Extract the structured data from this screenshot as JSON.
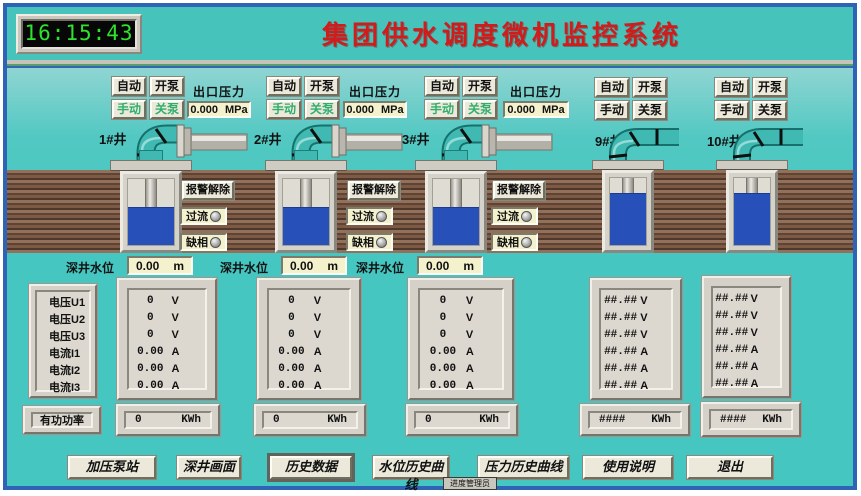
{
  "header": {
    "clock": "16:15:43",
    "title": "集团供水调度微机监控系统"
  },
  "controls": {
    "auto": "自动",
    "manual": "手动",
    "pump_on": "开泵",
    "pump_off": "关泵"
  },
  "stations": [
    {
      "name": "1#井",
      "pressure": {
        "label": "出口压力",
        "value": "0.000",
        "unit": "MPa"
      },
      "alarm": {
        "clear": "报警解除",
        "overcurrent": "过流",
        "phase_loss": "缺相"
      },
      "level": {
        "label": "深井水位",
        "value": "0.00",
        "unit": "m"
      },
      "meas": [
        {
          "v": "0",
          "u": "V"
        },
        {
          "v": "0",
          "u": "V"
        },
        {
          "v": "0",
          "u": "V"
        },
        {
          "v": "0.00",
          "u": "A"
        },
        {
          "v": "0.00",
          "u": "A"
        },
        {
          "v": "0.00",
          "u": "A"
        }
      ],
      "energy": {
        "v": "0",
        "u": "KWh"
      }
    },
    {
      "name": "2#井",
      "pressure": {
        "label": "出口压力",
        "value": "0.000",
        "unit": "MPa"
      },
      "alarm": {
        "clear": "报警解除",
        "overcurrent": "过流",
        "phase_loss": "缺相"
      },
      "level": {
        "label": "深井水位",
        "value": "0.00",
        "unit": "m"
      },
      "meas": [
        {
          "v": "0",
          "u": "V"
        },
        {
          "v": "0",
          "u": "V"
        },
        {
          "v": "0",
          "u": "V"
        },
        {
          "v": "0.00",
          "u": "A"
        },
        {
          "v": "0.00",
          "u": "A"
        },
        {
          "v": "0.00",
          "u": "A"
        }
      ],
      "energy": {
        "v": "0",
        "u": "KWh"
      }
    },
    {
      "name": "3#井",
      "pressure": {
        "label": "出口压力",
        "value": "0.000",
        "unit": "MPa"
      },
      "alarm": {
        "clear": "报警解除",
        "overcurrent": "过流",
        "phase_loss": "缺相"
      },
      "level": {
        "label": "深井水位",
        "value": "0.00",
        "unit": "m"
      },
      "meas": [
        {
          "v": "0",
          "u": "V"
        },
        {
          "v": "0",
          "u": "V"
        },
        {
          "v": "0",
          "u": "V"
        },
        {
          "v": "0.00",
          "u": "A"
        },
        {
          "v": "0.00",
          "u": "A"
        },
        {
          "v": "0.00",
          "u": "A"
        }
      ],
      "energy": {
        "v": "0",
        "u": "KWh"
      }
    },
    {
      "name": "9#井",
      "meas": [
        {
          "v": "##.##",
          "u": "V"
        },
        {
          "v": "##.##",
          "u": "V"
        },
        {
          "v": "##.##",
          "u": "V"
        },
        {
          "v": "##.##",
          "u": "A"
        },
        {
          "v": "##.##",
          "u": "A"
        },
        {
          "v": "##.##",
          "u": "A"
        }
      ],
      "energy": {
        "v": "####",
        "u": "KWh"
      }
    },
    {
      "name": "10#井",
      "meas": [
        {
          "v": "##.##",
          "u": "V"
        },
        {
          "v": "##.##",
          "u": "V"
        },
        {
          "v": "##.##",
          "u": "V"
        },
        {
          "v": "##.##",
          "u": "A"
        },
        {
          "v": "##.##",
          "u": "A"
        },
        {
          "v": "##.##",
          "u": "A"
        }
      ],
      "energy": {
        "v": "####",
        "u": "KWh"
      }
    }
  ],
  "left_panel": {
    "labels": [
      "电压U1",
      "电压U2",
      "电压U3",
      "电流I1",
      "电流I2",
      "电流I3"
    ],
    "power_label": "有功功率"
  },
  "nav": {
    "buttons": [
      "加压泵站",
      "深井画面",
      "历史数据",
      "水位历史曲线",
      "压力历史曲线",
      "使用说明",
      "退出"
    ]
  },
  "taskbar": {
    "item": "进度管理员"
  },
  "colors": {
    "background": "#45c6c0",
    "title_red": "#cf1d1d",
    "clock_green": "#2ee22e",
    "water_blue": "#2750b8",
    "earth_brown": "#7d5a45",
    "frame_blue": "#2e63b5",
    "button_face": "#ece9db",
    "value_box": "#f4f1cd"
  }
}
